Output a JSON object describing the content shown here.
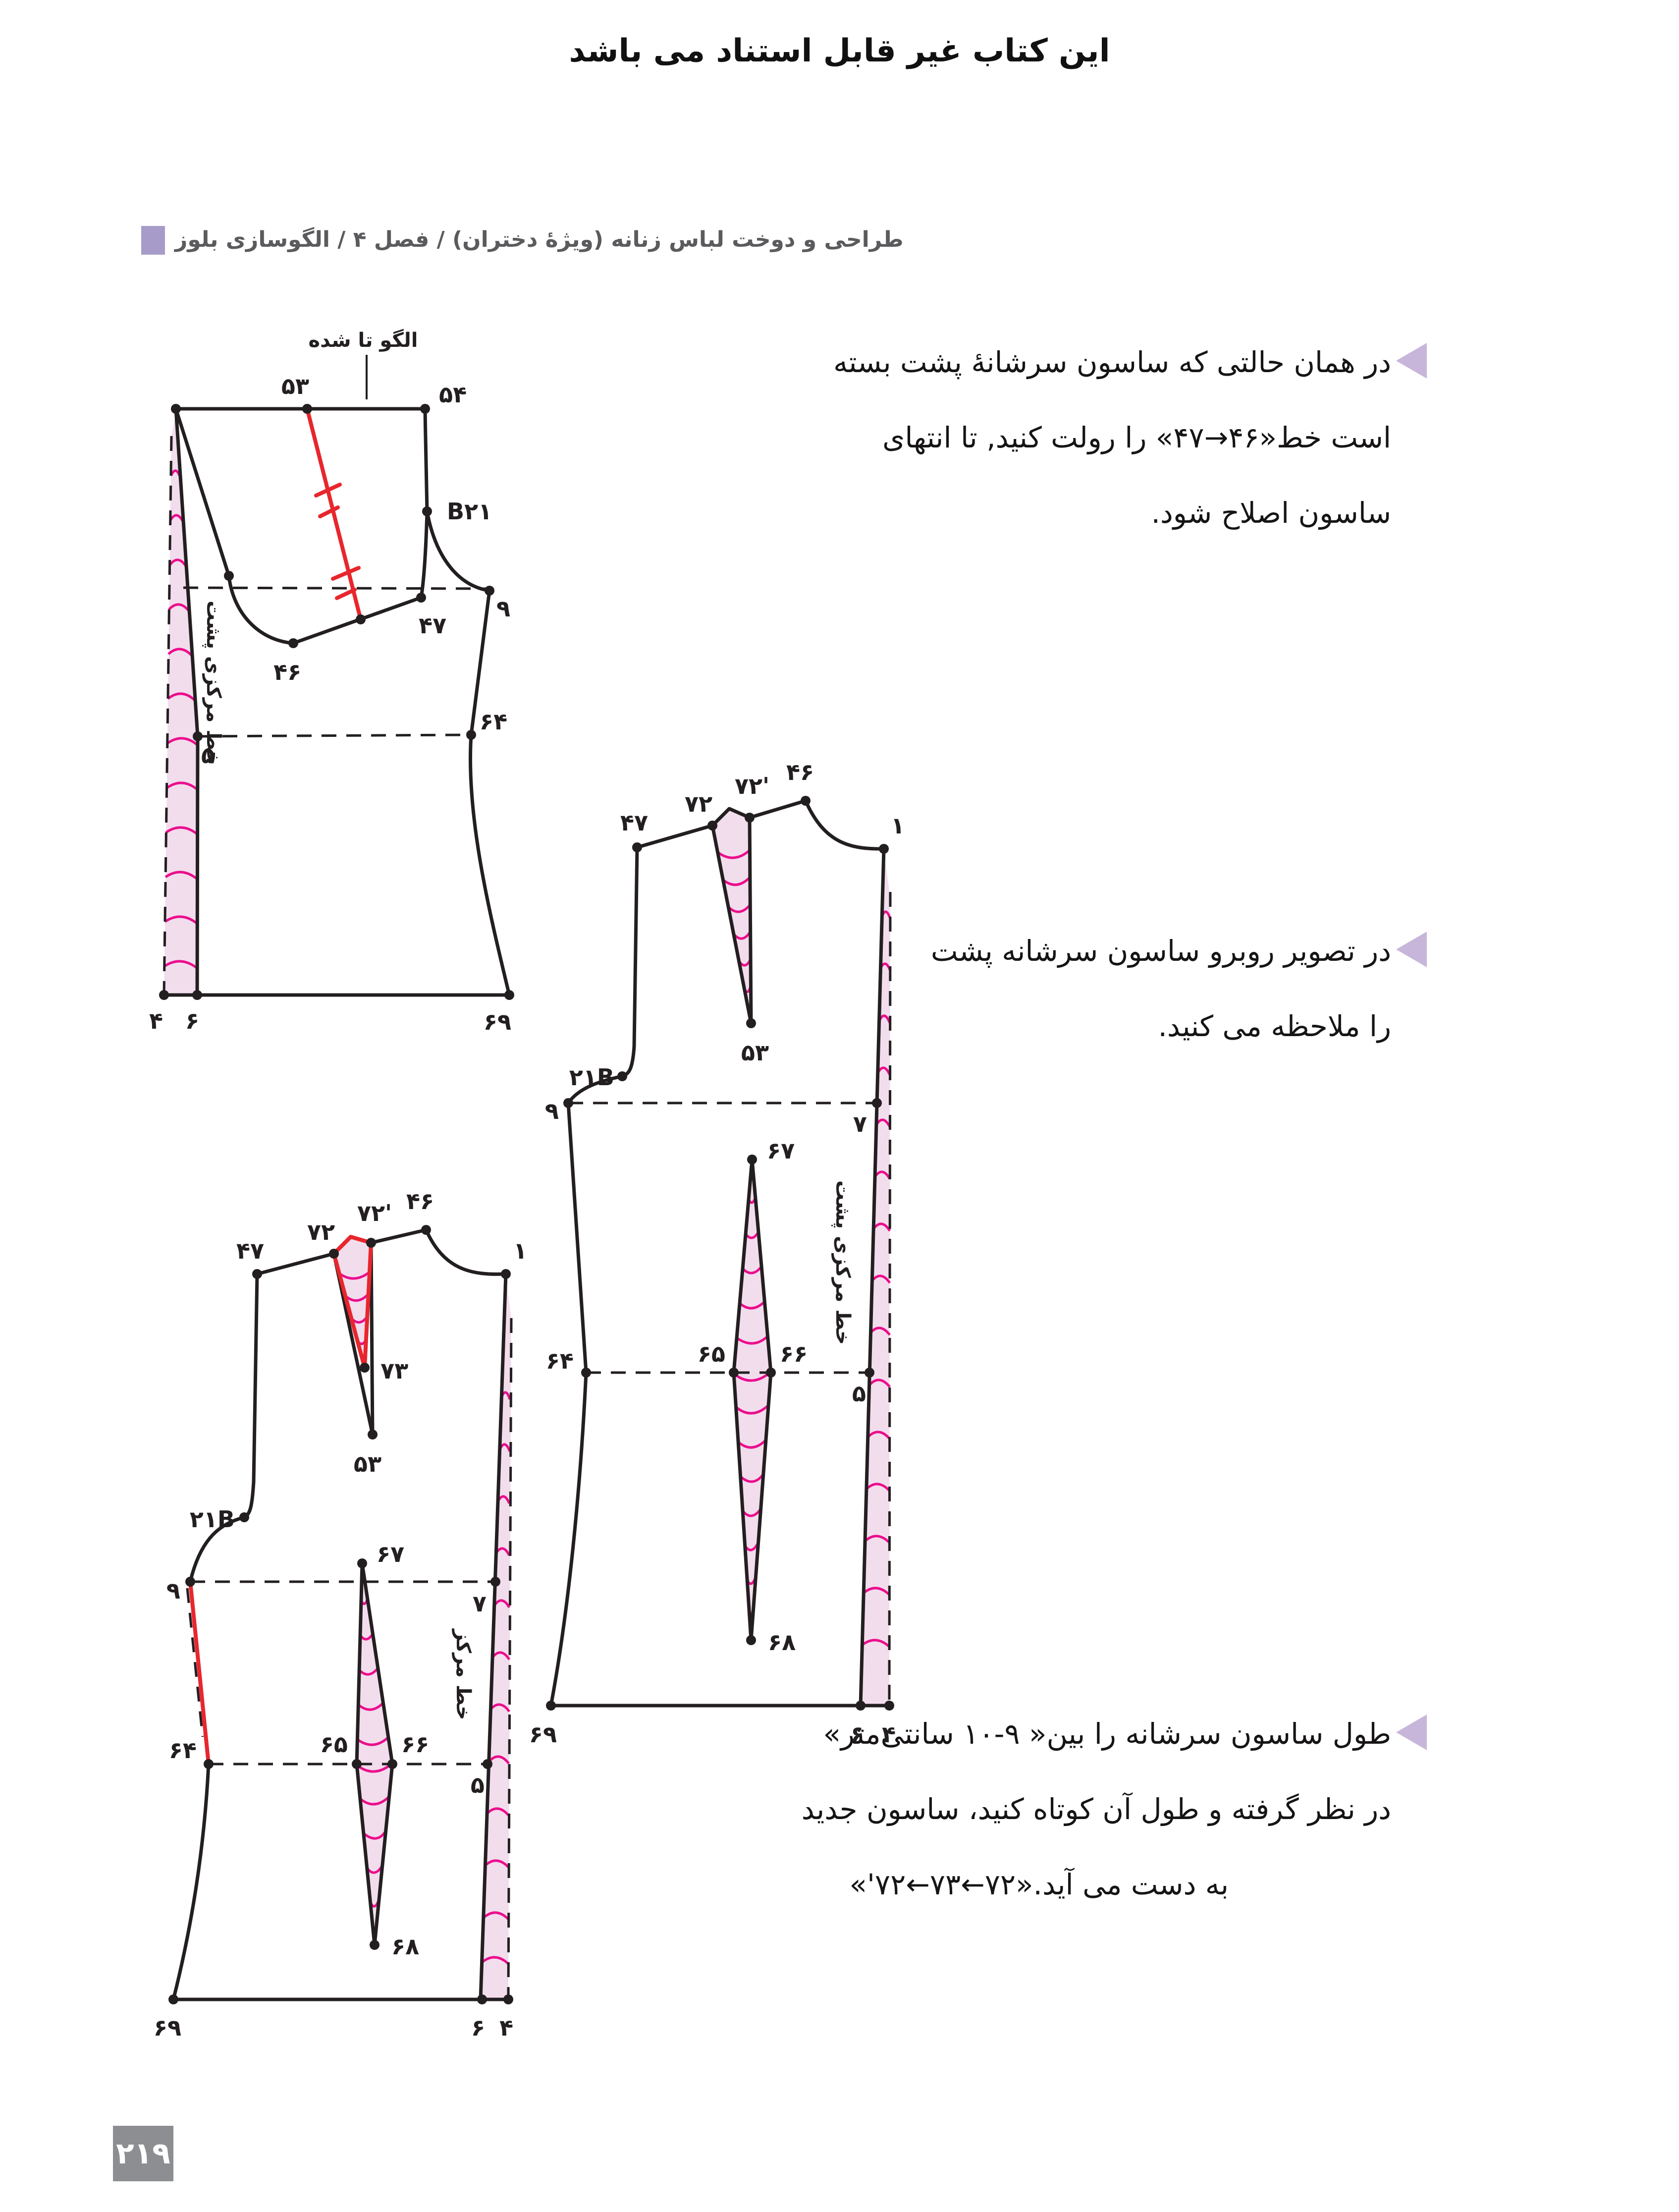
{
  "page": {
    "disclaimer": "این کتاب غیر قابل استناد می باشد",
    "chapter_header": "طراحی و دوخت لباس زنانه (ویژهٔ دختران) / فصل ۴ / الگوسازی بلوز",
    "page_number": "۲۱۹"
  },
  "colors": {
    "accent_purple": "#a79cc9",
    "bullet_purple": "#c7b6da",
    "badge_gray": "#8c8e91",
    "pink_fill": "#f2dded",
    "magenta": "#eb0d8c",
    "red": "#e8262d",
    "line_black": "#231f20"
  },
  "paragraphs": {
    "p1": {
      "l1": "در همان حالتی که ساسون سرشانهٔ پشت بسته",
      "l2a": "است خط",
      "l2q": "«۴۷→۴۶»",
      "l2b": " را رولت کنید, تا انتهای",
      "l3": "ساسون اصلاح شود."
    },
    "p2": {
      "l1": "در تصویر روبرو ساسون سرشانه پشت",
      "l2": "را ملاحظه می کنید."
    },
    "p3": {
      "l1": "طول ساسون سرشانه را بین« ۹-۱۰ سانتی‌متر»",
      "l2": "در نظر گرفته و طول آن کوتاه کنید، ساسون جدید",
      "l3b": "به دست می آید.",
      "l3q": "«'۷۲←۷۳←۷۲»"
    }
  },
  "diagrams": {
    "d1": {
      "fold": "الگو تا شده",
      "cb": "خط مرکزی پشت",
      "n53": "۵۳",
      "n54": "۵۴",
      "nB21": "B۲۱",
      "n9": "۹",
      "n47": "۴۷",
      "n46": "۴۶",
      "n5": "۵",
      "n64": "۶۴",
      "n4": "۴",
      "n6": "۶",
      "n69": "۶۹"
    },
    "d2": {
      "cb": "خط مرکزی پشت",
      "n47": "۴۷",
      "n72": "۷۲",
      "n72p": "۷۲'",
      "n46": "۴۶",
      "n1": "۱",
      "n53": "۵۳",
      "n21B": "۲۱B",
      "n9": "۹",
      "n7": "۷",
      "n67": "۶۷",
      "n64": "۶۴",
      "n65": "۶۵",
      "n66": "۶۶",
      "n5": "۵",
      "n68": "۶۸",
      "n69": "۶۹",
      "n6": "۶",
      "n4": "۴"
    },
    "d3": {
      "cb": "خط مرکز",
      "n47": "۴۷",
      "n72": "۷۲",
      "n72p": "۷۲'",
      "n46": "۴۶",
      "n1": "۱",
      "n73": "۷۳",
      "n53": "۵۳",
      "n21B": "۲۱B",
      "n9": "۹",
      "n7": "۷",
      "n67": "۶۷",
      "n64": "۶۴",
      "n65": "۶۵",
      "n66": "۶۶",
      "n5": "۵",
      "n68": "۶۸",
      "n69": "۶۹",
      "n6": "۶",
      "n4": "۴"
    }
  }
}
